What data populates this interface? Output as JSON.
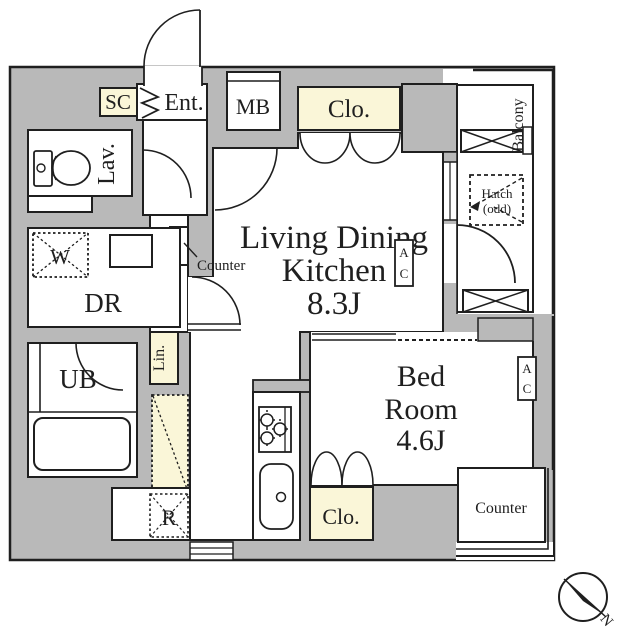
{
  "plan": {
    "title": "1LDK apartment floor plan",
    "rooms": {
      "ldk_line1": "Living Dining",
      "ldk_line2": "Kitchen",
      "ldk_size": "8.3J",
      "bed_line1": "Bed",
      "bed_line2": "Room",
      "bed_size": "4.6J",
      "ent": "Ent.",
      "sc": "SC",
      "mb": "MB",
      "clo_top": "Clo.",
      "clo_bed": "Clo.",
      "lav": "Lav.",
      "dr": "DR",
      "ub": "UB",
      "lin": "Lin.",
      "w": "W",
      "r": "R",
      "balcony": "Balcony",
      "hatch_line1": "Hatch",
      "hatch_line2": "(odd)",
      "counter_hall": "Counter",
      "counter_bed": "Counter",
      "ac_a": "A",
      "ac_c": "C",
      "compass_n": "N"
    },
    "colors": {
      "wall": "#b9b9b9",
      "accent": "#faf6d8",
      "line": "#1f1f1f",
      "floor": "#ffffff"
    }
  }
}
